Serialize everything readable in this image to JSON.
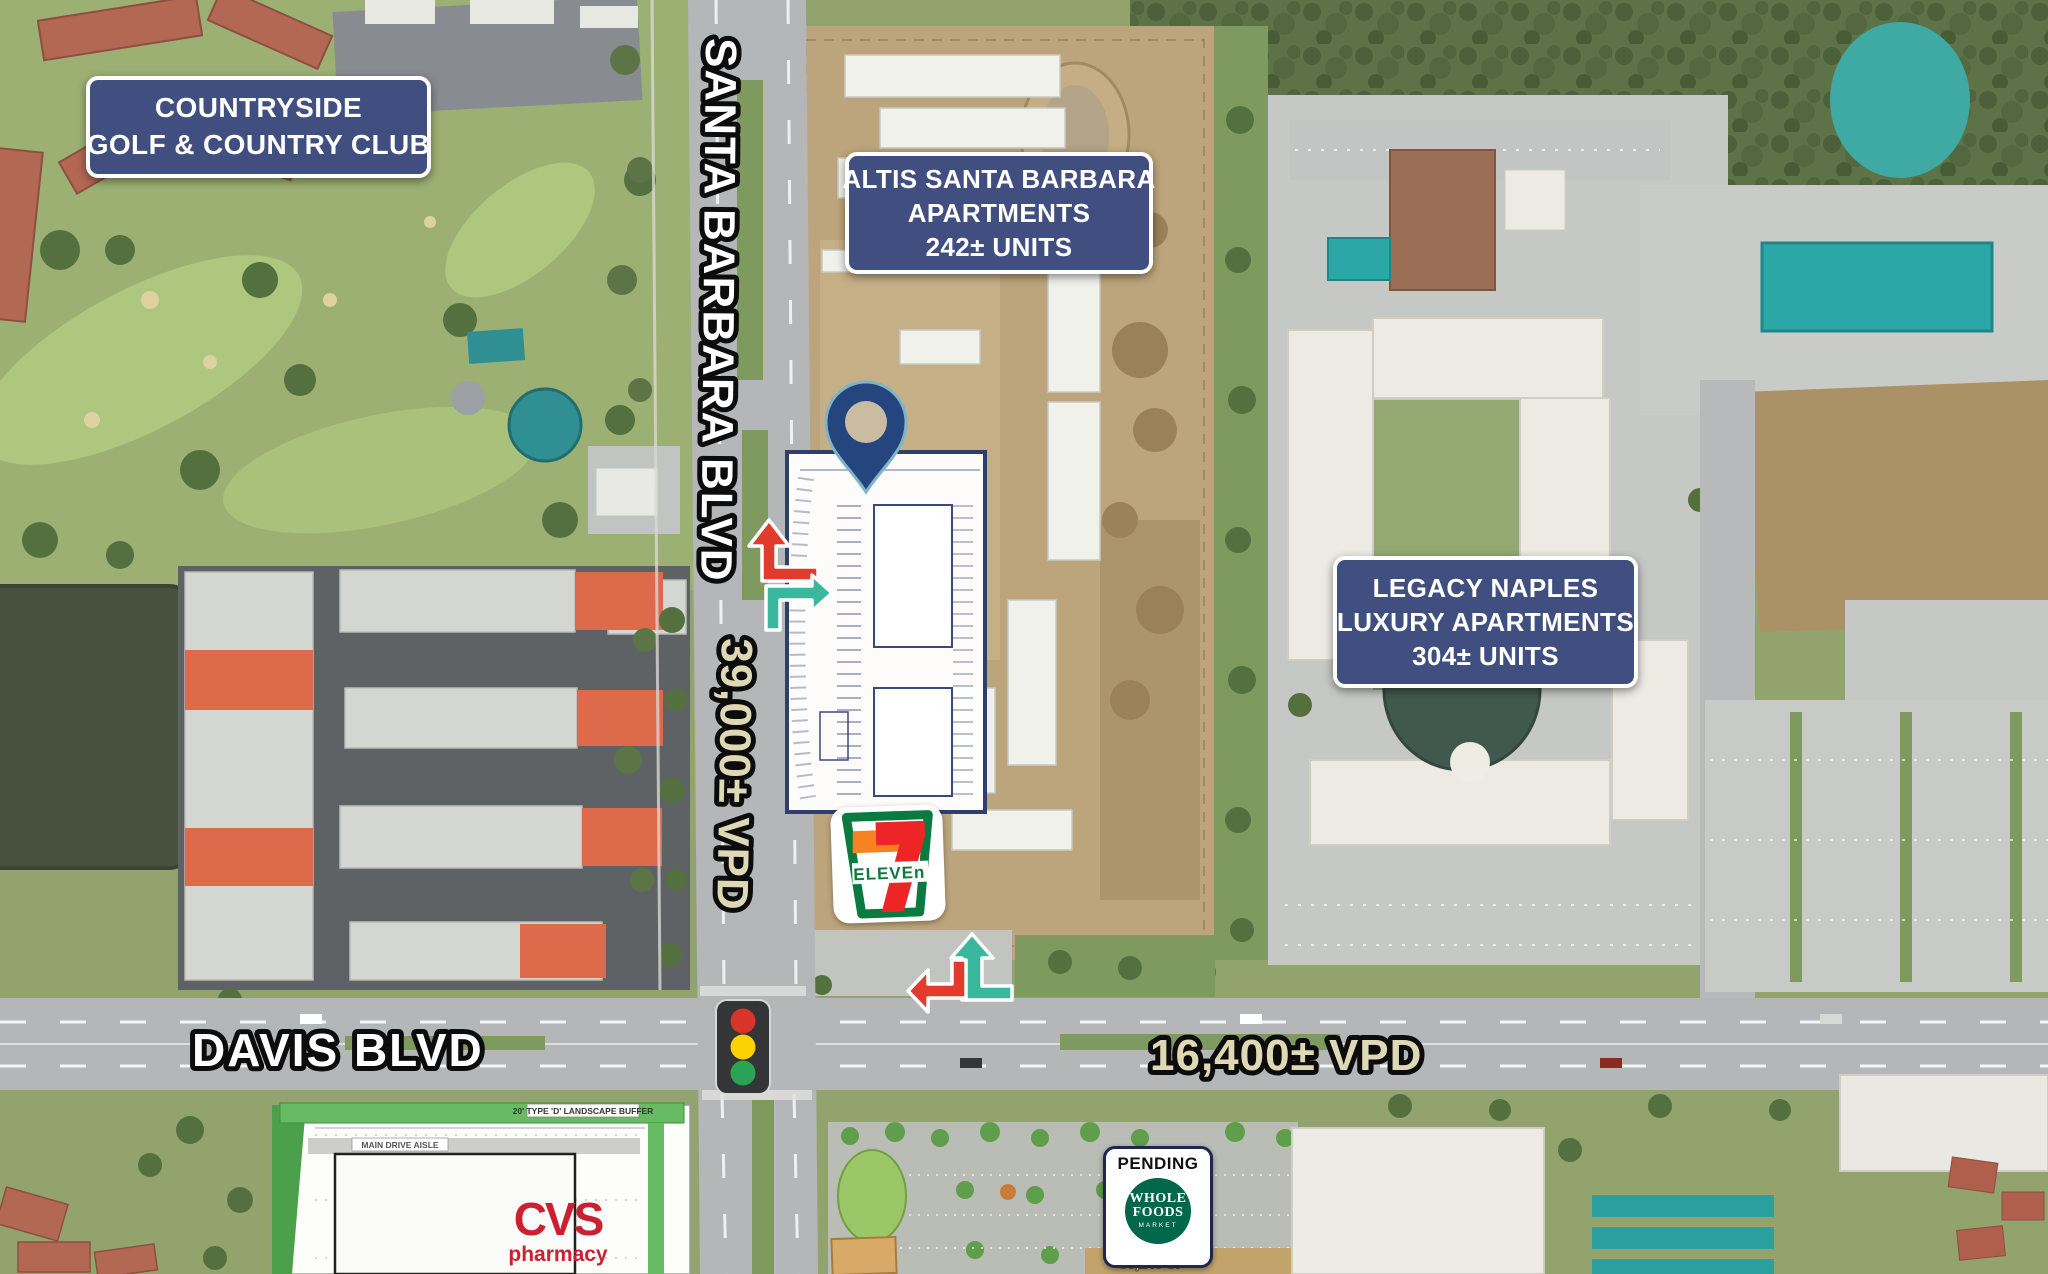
{
  "signs": {
    "countryside": {
      "line1": "COUNTRYSIDE",
      "line2": "GOLF & COUNTRY CLUB"
    },
    "altis": {
      "line1": "ALTIS SANTA BARBARA",
      "line2": "APARTMENTS",
      "line3": "242± UNITS"
    },
    "legacy": {
      "line1": "LEGACY NAPLES",
      "line2": "LUXURY APARTMENTS",
      "line3": "304± UNITS"
    }
  },
  "roads": {
    "santa_barbara": "SANTA BARBARA BLVD",
    "davis": "DAVIS BLVD"
  },
  "traffic_counts": {
    "santa_barbara": "39,000± VPD",
    "davis": "16,400± VPD"
  },
  "pending_site": {
    "status": "PENDING",
    "building_sf": "30,140 SF"
  },
  "brands": {
    "seven_eleven": {
      "numeral": "7",
      "word": "ELEVEn"
    },
    "whole_foods": {
      "line1": "WHOLE",
      "line2": "FOODS",
      "line3": "MARKET"
    },
    "cvs": {
      "name": "CVS",
      "sub": "pharmacy"
    }
  },
  "site_plan_notes": {
    "buffer": "20' TYPE 'D' LANDSCAPE BUFFER",
    "drive_aisle": "MAIN DRIVE AISLE"
  },
  "colors": {
    "sign_navy": "#414f80",
    "vpd_text": "#ded9b4",
    "arrow_red": "#e23b2e",
    "arrow_teal": "#3ab79c",
    "pin_navy": "#24457e"
  }
}
